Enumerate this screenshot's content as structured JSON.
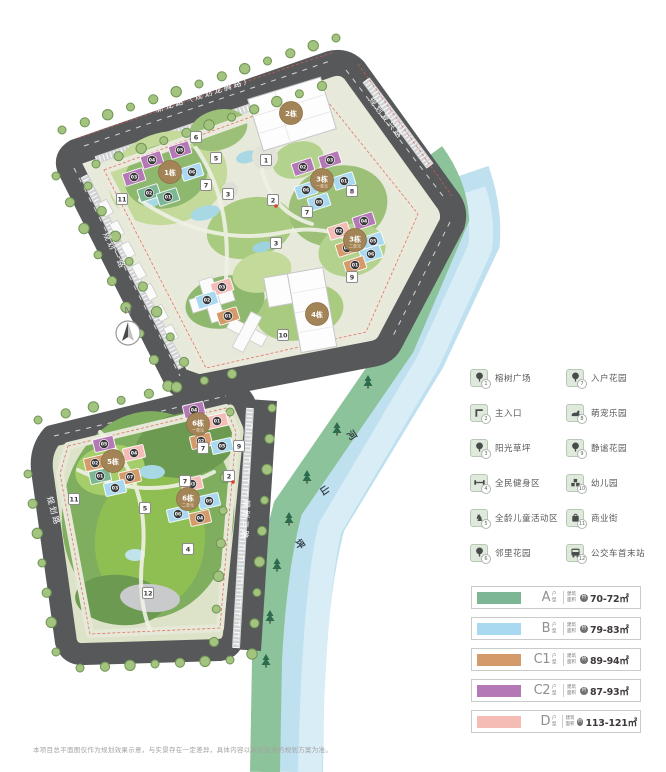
{
  "compass": {
    "label": "N"
  },
  "map": {
    "roads": [
      {
        "name": "新龙路（规划龙腾路）",
        "x": 205,
        "y": 97,
        "rot": -17.5
      },
      {
        "name": "规划复兴路",
        "x": 384,
        "y": 120,
        "rot": 52
      },
      {
        "name": "规划一路",
        "x": 112,
        "y": 252,
        "rot": 63
      },
      {
        "name": "规划路",
        "x": 108,
        "y": 397,
        "rot": -13
      },
      {
        "name": "规划路",
        "x": 51,
        "y": 512,
        "rot": 74
      },
      {
        "name": "规划二路",
        "x": 243,
        "y": 520,
        "rot": 93
      }
    ],
    "river": {
      "name": "坪山河"
    },
    "clusters": [
      {
        "label": "1栋",
        "sub": "",
        "x": 170,
        "y": 172
      },
      {
        "label": "2栋",
        "sub": "",
        "x": 291,
        "y": 113
      },
      {
        "label": "3栋",
        "sub": "一单元",
        "x": 322,
        "y": 180
      },
      {
        "label": "3栋",
        "sub": "二单元",
        "x": 355,
        "y": 240
      },
      {
        "label": "4栋",
        "sub": "",
        "x": 317,
        "y": 314
      },
      {
        "label": "5栋",
        "sub": "",
        "x": 113,
        "y": 461
      },
      {
        "label": "6栋",
        "sub": "一单元",
        "x": 198,
        "y": 424
      },
      {
        "label": "6栋",
        "sub": "二单元",
        "x": 188,
        "y": 499
      }
    ],
    "buildings": [
      {
        "l": "05",
        "t": "C2",
        "x": 180,
        "y": 150,
        "r": -18
      },
      {
        "l": "04",
        "t": "C2",
        "x": 152,
        "y": 160,
        "r": -18
      },
      {
        "l": "03",
        "t": "C2",
        "x": 134,
        "y": 177,
        "r": -18
      },
      {
        "l": "02",
        "t": "A",
        "x": 149,
        "y": 193,
        "r": -18
      },
      {
        "l": "01",
        "t": "A",
        "x": 168,
        "y": 197,
        "r": -18
      },
      {
        "l": "06",
        "t": "B",
        "x": 192,
        "y": 172,
        "r": -18
      },
      {
        "l": "02",
        "t": "C2",
        "x": 303,
        "y": 167,
        "r": -18
      },
      {
        "l": "03",
        "t": "C2",
        "x": 330,
        "y": 160,
        "r": -18
      },
      {
        "l": "01",
        "t": "B",
        "x": 344,
        "y": 181,
        "r": -18
      },
      {
        "l": "06",
        "t": "B",
        "x": 306,
        "y": 190,
        "r": -18
      },
      {
        "l": "05",
        "t": "B",
        "x": 319,
        "y": 202,
        "r": -18
      },
      {
        "l": "04",
        "t": "C2",
        "x": 364,
        "y": 221,
        "r": -18
      },
      {
        "l": "02",
        "t": "D",
        "x": 339,
        "y": 231,
        "r": -18
      },
      {
        "l": "05",
        "t": "B",
        "x": 373,
        "y": 241,
        "r": -18
      },
      {
        "l": "06",
        "t": "B",
        "x": 371,
        "y": 254,
        "r": -18
      },
      {
        "l": "03",
        "t": "C1",
        "x": 347,
        "y": 248,
        "r": -18
      },
      {
        "l": "01",
        "t": "C1",
        "x": 355,
        "y": 265,
        "r": -18
      },
      {
        "l": "03",
        "t": "D",
        "x": 222,
        "y": 287,
        "r": -18
      },
      {
        "l": "02",
        "t": "B",
        "x": 207,
        "y": 300,
        "r": -18
      },
      {
        "l": "01",
        "t": "C1",
        "x": 228,
        "y": 316,
        "r": -18
      },
      {
        "l": "04",
        "t": "C2",
        "x": 194,
        "y": 410,
        "r": -13
      },
      {
        "l": "01",
        "t": "D",
        "x": 217,
        "y": 421,
        "r": -13
      },
      {
        "l": "02",
        "t": "C1",
        "x": 201,
        "y": 441,
        "r": -13
      },
      {
        "l": "05",
        "t": "B",
        "x": 222,
        "y": 446,
        "r": -13
      },
      {
        "l": "05",
        "t": "C2",
        "x": 104,
        "y": 444,
        "r": -13
      },
      {
        "l": "04",
        "t": "D",
        "x": 134,
        "y": 453,
        "r": -13
      },
      {
        "l": "02",
        "t": "C1",
        "x": 95,
        "y": 463,
        "r": -13
      },
      {
        "l": "07",
        "t": "C1",
        "x": 130,
        "y": 477,
        "r": -13
      },
      {
        "l": "01",
        "t": "A",
        "x": 100,
        "y": 476,
        "r": -13
      },
      {
        "l": "03",
        "t": "B",
        "x": 115,
        "y": 488,
        "r": -13
      },
      {
        "l": "03",
        "t": "D",
        "x": 192,
        "y": 484,
        "r": -13
      },
      {
        "l": "05",
        "t": "B",
        "x": 209,
        "y": 501,
        "r": -13
      },
      {
        "l": "04",
        "t": "C1",
        "x": 200,
        "y": 518,
        "r": -13
      },
      {
        "l": "06",
        "t": "B",
        "x": 178,
        "y": 514,
        "r": -13
      }
    ],
    "badges": [
      {
        "n": "6",
        "x": 196,
        "y": 137
      },
      {
        "n": "5",
        "x": 216,
        "y": 158
      },
      {
        "n": "1",
        "x": 266,
        "y": 160
      },
      {
        "n": "7",
        "x": 206,
        "y": 185
      },
      {
        "n": "3",
        "x": 228,
        "y": 194
      },
      {
        "n": "2",
        "x": 273,
        "y": 200
      },
      {
        "n": "8",
        "x": 352,
        "y": 191
      },
      {
        "n": "7",
        "x": 307,
        "y": 212
      },
      {
        "n": "3",
        "x": 276,
        "y": 243
      },
      {
        "n": "9",
        "x": 352,
        "y": 277
      },
      {
        "n": "10",
        "x": 283,
        "y": 335
      },
      {
        "n": "11",
        "x": 122,
        "y": 199
      },
      {
        "n": "7",
        "x": 203,
        "y": 448
      },
      {
        "n": "9",
        "x": 239,
        "y": 446
      },
      {
        "n": "2",
        "x": 229,
        "y": 476
      },
      {
        "n": "7",
        "x": 185,
        "y": 481
      },
      {
        "n": "11",
        "x": 74,
        "y": 499
      },
      {
        "n": "5",
        "x": 145,
        "y": 508
      },
      {
        "n": "4",
        "x": 188,
        "y": 549
      },
      {
        "n": "12",
        "x": 148,
        "y": 593
      }
    ]
  },
  "legend": {
    "items": [
      {
        "num": "1",
        "label": "榕树广场",
        "icon": "tree"
      },
      {
        "num": "2",
        "label": "主入口",
        "icon": "gate"
      },
      {
        "num": "3",
        "label": "阳光草坪",
        "icon": "tree"
      },
      {
        "num": "4",
        "label": "全民健身区",
        "icon": "fitness"
      },
      {
        "num": "5",
        "label": "全龄儿童活动区",
        "icon": "rocking-horse"
      },
      {
        "num": "6",
        "label": "邻里花园",
        "icon": "tree"
      },
      {
        "num": "7",
        "label": "入户花园",
        "icon": "tree"
      },
      {
        "num": "8",
        "label": "萌宠乐园",
        "icon": "pet"
      },
      {
        "num": "9",
        "label": "静谧花园",
        "icon": "tree"
      },
      {
        "num": "10",
        "label": "幼儿园",
        "icon": "kindergarten"
      },
      {
        "num": "11",
        "label": "商业街",
        "icon": "shop"
      },
      {
        "num": "12",
        "label": "公交车首末站",
        "icon": "bus"
      }
    ]
  },
  "types": {
    "labels": {
      "unit": "户型",
      "area": "建筑面积",
      "approx": "约"
    },
    "rows": [
      {
        "code": "A",
        "area": "70-72㎡",
        "color": "#7cb694"
      },
      {
        "code": "B",
        "area": "79-83㎡",
        "color": "#a9d9f0"
      },
      {
        "code": "C1",
        "area": "89-94㎡",
        "color": "#d59a69"
      },
      {
        "code": "C2",
        "area": "87-93㎡",
        "color": "#b478b6"
      },
      {
        "code": "D",
        "area": "113-121㎡",
        "color": "#f5bcb6"
      }
    ]
  },
  "disclaimer": "本项目总平面图仅作为规划效果示意，与实景存在一定差异，具体内容以政府批准的规划方案为准。"
}
